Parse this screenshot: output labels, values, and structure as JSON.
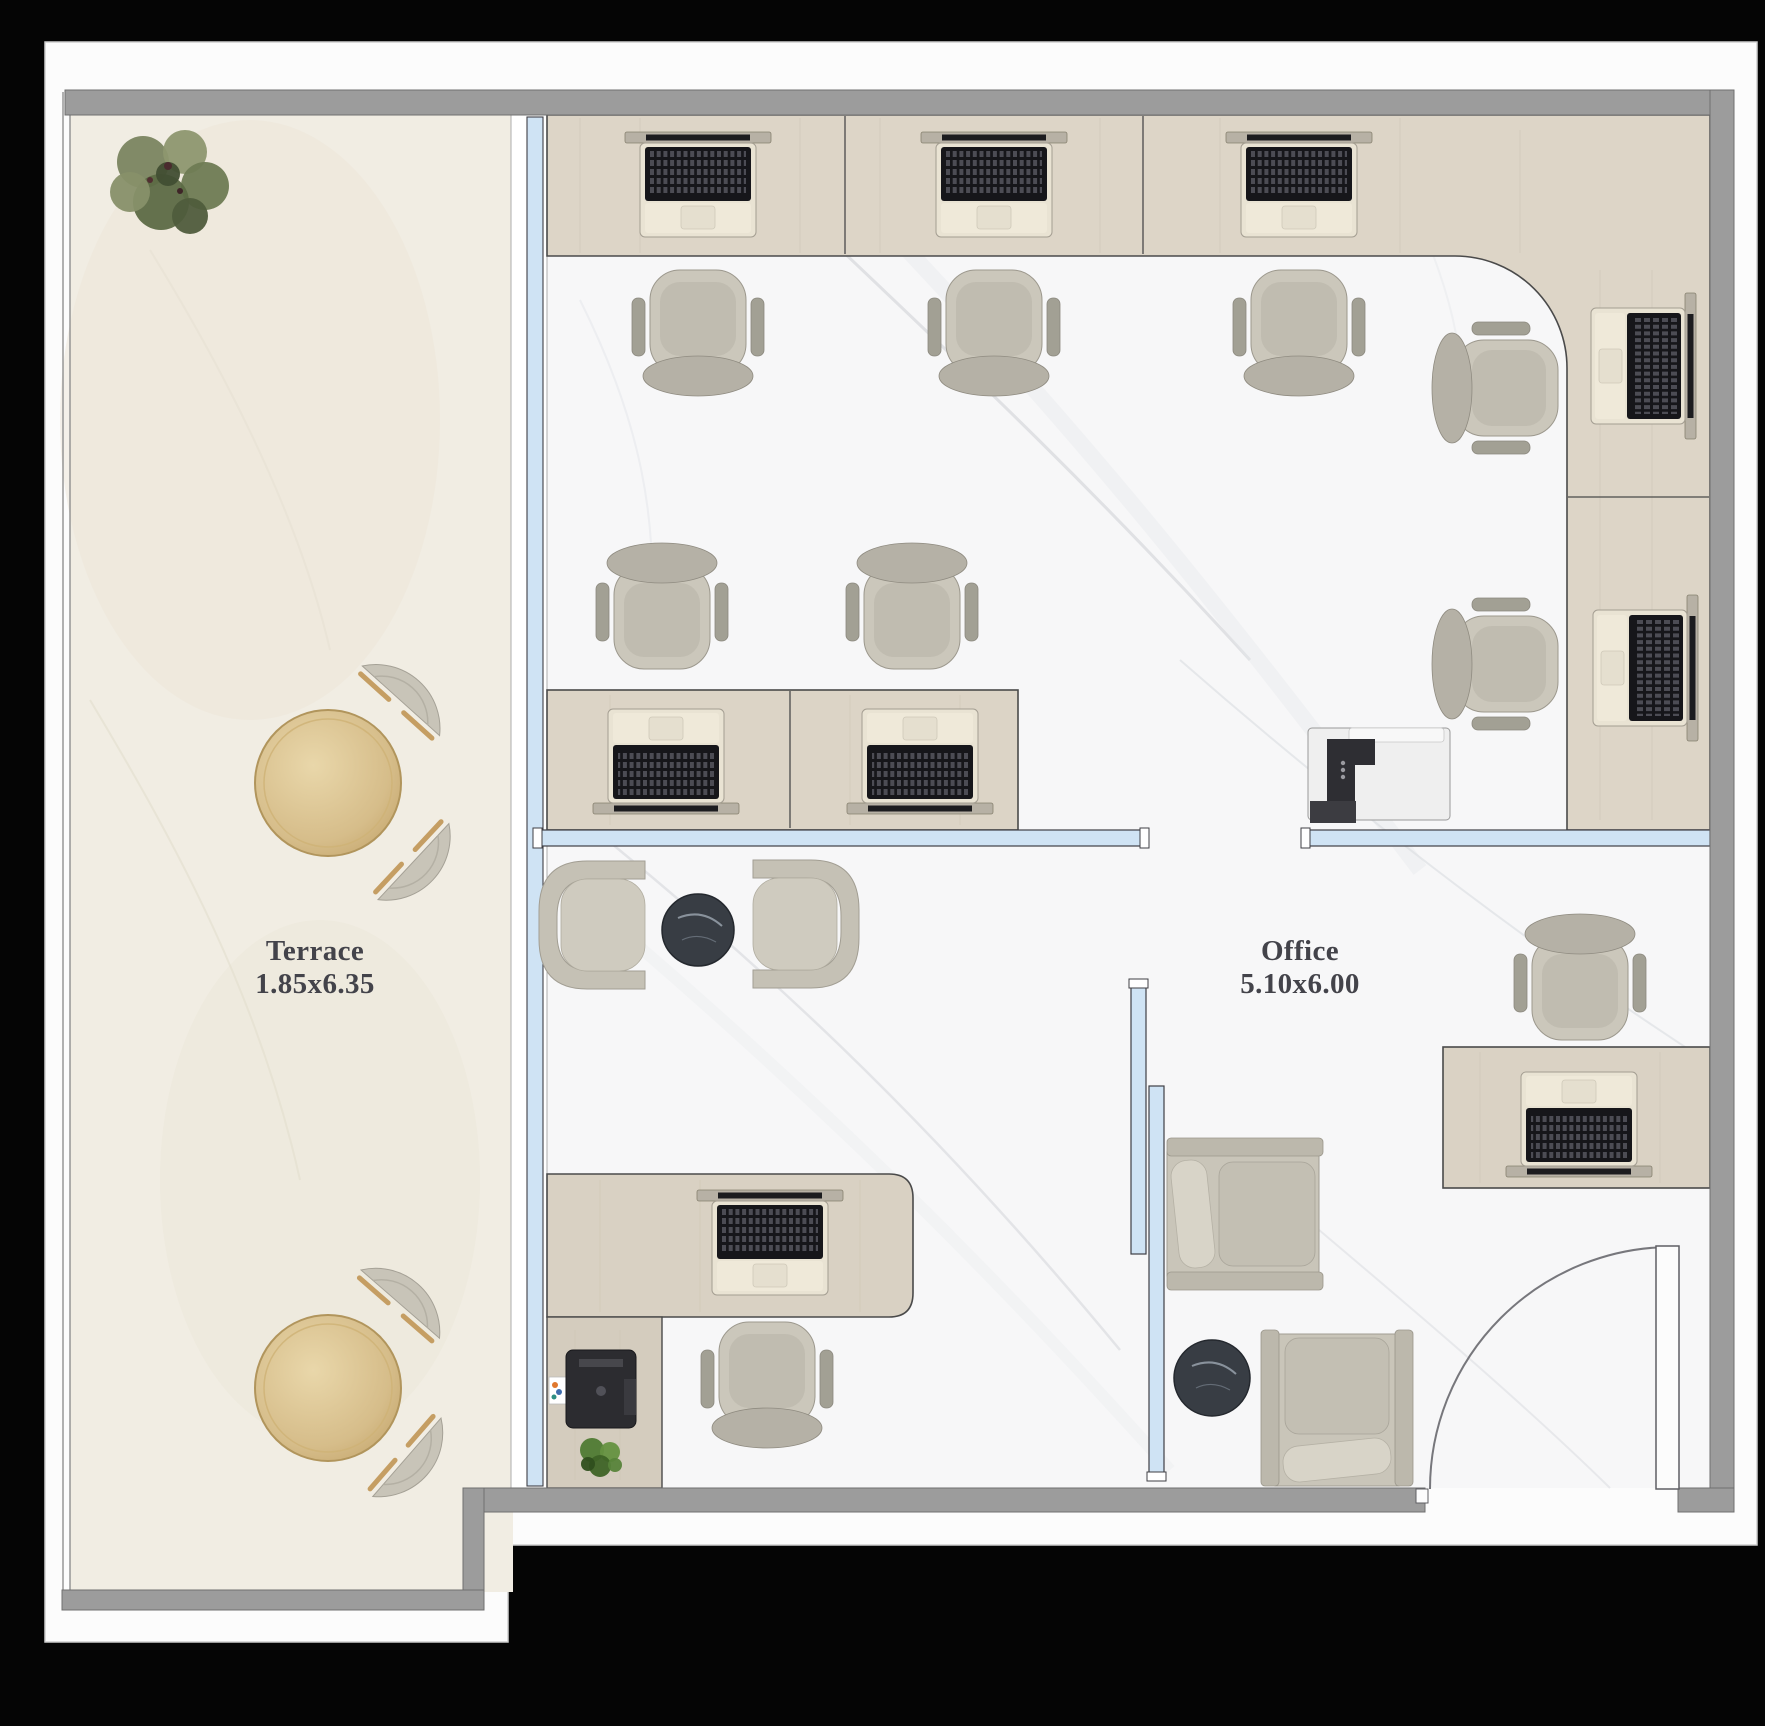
{
  "rooms": [
    {
      "id": "terrace",
      "name": "Terrace",
      "dimensions": "1.85x6.35"
    },
    {
      "id": "office",
      "name": "Office",
      "dimensions": "5.10x6.00"
    }
  ],
  "colors": {
    "background": "#050505",
    "page": "#fcfcfc",
    "wall": "#9c9c9c",
    "glass": "#cfe3f4",
    "terrace_floor": "#f1ede3",
    "office_floor": "#f7f7f8",
    "desk_wood": "#ddd5c7",
    "chair_fabric": "#cbc7bb",
    "table_gold": "#d6bd8a",
    "side_table": "#383d44",
    "plant_green": "#6e7b53"
  },
  "furniture": {
    "task_chairs": [
      {
        "x": 698,
        "y": 322,
        "rot": 180
      },
      {
        "x": 994,
        "y": 322,
        "rot": 180
      },
      {
        "x": 1299,
        "y": 322,
        "rot": 180
      },
      {
        "x": 662,
        "y": 617,
        "rot": 0
      },
      {
        "x": 912,
        "y": 617,
        "rot": 0
      },
      {
        "x": 1506,
        "y": 388,
        "rot": 270
      },
      {
        "x": 1506,
        "y": 664,
        "rot": 270
      },
      {
        "x": 767,
        "y": 1374,
        "rot": 180
      },
      {
        "x": 1580,
        "y": 988,
        "rot": 0
      }
    ],
    "laptops": [
      {
        "x": 698,
        "y": 190,
        "rot": 0
      },
      {
        "x": 994,
        "y": 190,
        "rot": 0
      },
      {
        "x": 1299,
        "y": 190,
        "rot": 0
      },
      {
        "x": 1638,
        "y": 366,
        "rot": 90
      },
      {
        "x": 1640,
        "y": 668,
        "rot": 90
      },
      {
        "x": 666,
        "y": 756,
        "rot": 180
      },
      {
        "x": 920,
        "y": 756,
        "rot": 180
      },
      {
        "x": 770,
        "y": 1248,
        "rot": 0
      },
      {
        "x": 1579,
        "y": 1119,
        "rot": 180
      }
    ],
    "terrace_tables": [
      {
        "x": 328,
        "y": 783,
        "r": 73
      },
      {
        "x": 328,
        "y": 1388,
        "r": 73
      }
    ],
    "terrace_chairs": [
      {
        "x": 417,
        "y": 683,
        "rot": -48
      },
      {
        "x": 431,
        "y": 878,
        "rot": 43
      },
      {
        "x": 416,
        "y": 1286,
        "rot": -49
      },
      {
        "x": 425,
        "y": 1473,
        "rot": 41
      }
    ],
    "lounge_chairs": [
      {
        "x": 601,
        "y": 925,
        "rot": 0
      },
      {
        "x": 797,
        "y": 924,
        "rot": 180
      }
    ],
    "armchairs": [
      {
        "x": 1245,
        "y": 1214,
        "rot": 0
      },
      {
        "x": 1337,
        "y": 1408,
        "rot": -90
      }
    ],
    "side_tables": [
      {
        "x": 698,
        "y": 930,
        "r": 36
      },
      {
        "x": 1212,
        "y": 1378,
        "r": 38
      }
    ],
    "printers": [
      {
        "x": 1379,
        "y": 775,
        "variant": "floor"
      },
      {
        "x": 601,
        "y": 1389,
        "variant": "desktop"
      }
    ],
    "plants": [
      {
        "x": 163,
        "y": 188,
        "variant": "large"
      },
      {
        "x": 601,
        "y": 1459,
        "variant": "small"
      }
    ]
  },
  "inventory": {
    "workstation_seats": 7,
    "private_desks": 2,
    "terrace_seating_groups": 2,
    "lounge_armchairs": 2,
    "office_armchairs": 2,
    "laptops": 9,
    "printers": 2,
    "plants": 2
  }
}
